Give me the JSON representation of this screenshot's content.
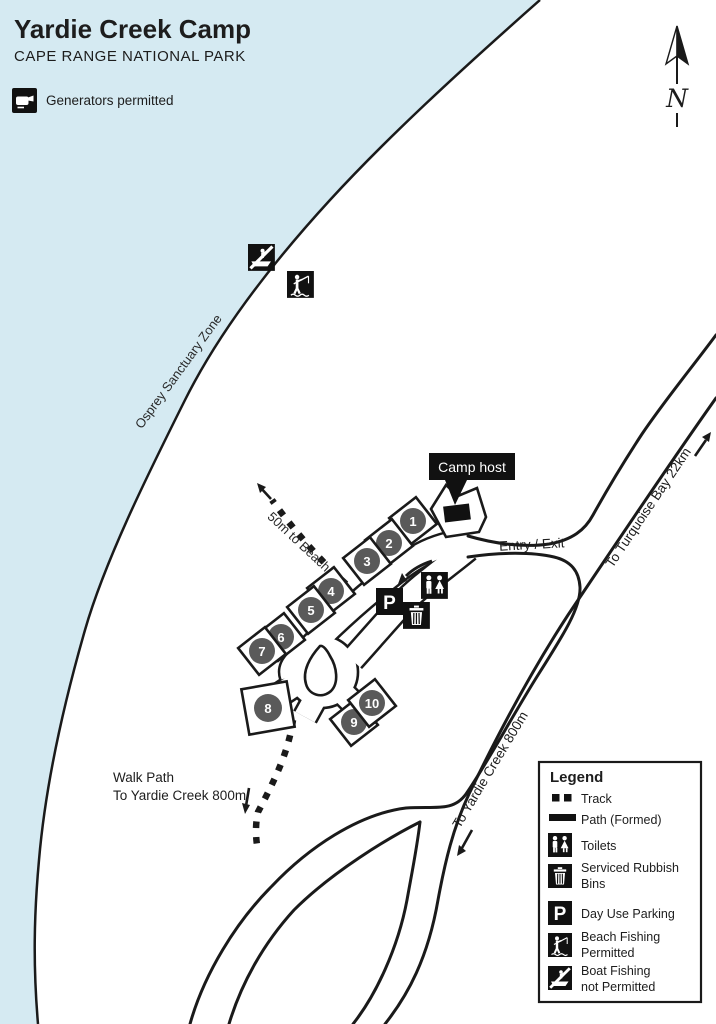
{
  "header": {
    "title": "Yardie Creek Camp",
    "subtitle": "CAPE RANGE NATIONAL PARK",
    "note_label": "Generators permitted"
  },
  "compass": {
    "label": "N"
  },
  "map": {
    "water_color": "#d5eaf2",
    "site_circle_color": "#5a5a5a",
    "zone_label": "Osprey Sanctuary Zone",
    "beach_track_label": "50m to Beach",
    "camp_host_label": "Camp host",
    "entry_exit_label": "Entry / Exit",
    "to_turquoise_label": "To Turquoise Bay 22km",
    "to_yardie_road_label": "To Yardie Creek 800m",
    "walk_path_label_line1": "Walk Path",
    "walk_path_label_line2": "To Yardie Creek 800m",
    "parking_letter": "P",
    "campsites": [
      "1",
      "2",
      "3",
      "4",
      "5",
      "6",
      "7",
      "8",
      "9",
      "10"
    ]
  },
  "legend": {
    "title": "Legend",
    "items": [
      {
        "icon": "track-icon",
        "line1": "Track"
      },
      {
        "icon": "path-formed-icon",
        "line1": "Path (Formed)"
      },
      {
        "icon": "toilets-icon",
        "line1": "Toilets"
      },
      {
        "icon": "rubbish-bins-icon",
        "line1": "Serviced Rubbish",
        "line2": "Bins"
      },
      {
        "icon": "day-use-parking-icon",
        "line1": "Day Use Parking"
      },
      {
        "icon": "beach-fishing-icon",
        "line1": "Beach Fishing",
        "line2": "Permitted"
      },
      {
        "icon": "boat-fishing-icon",
        "line1": "Boat Fishing",
        "line2": "not Permitted"
      }
    ]
  }
}
